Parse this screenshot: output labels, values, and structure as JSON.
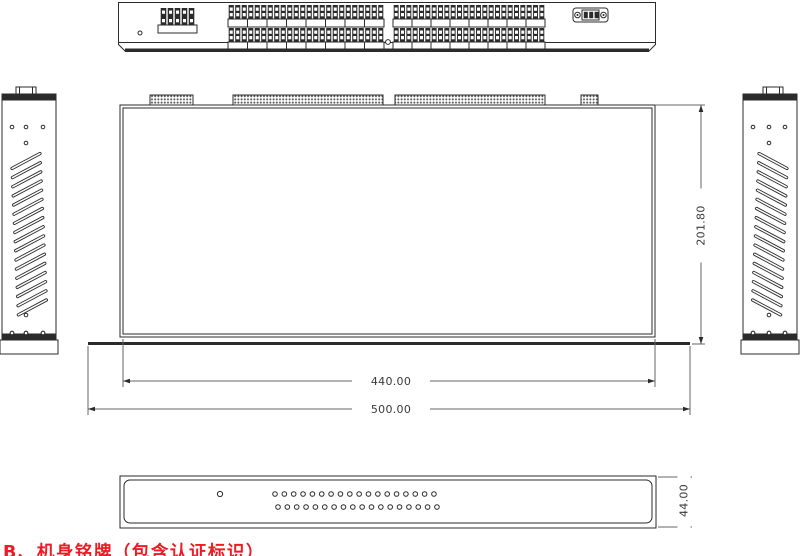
{
  "note": {
    "text": "B、机身铭牌（包含认证标识）"
  },
  "dimensions": {
    "inner_width_mm": "440.00",
    "outer_width_mm": "500.00",
    "depth_mm": "201.80",
    "height_mm": "44.00"
  },
  "views": {
    "rear_panel": {
      "small_terminal_pins": 5,
      "terminal_groups": [
        {
          "rows": 2,
          "segments": 8,
          "pins_per_segment": 3
        },
        {
          "rows": 2,
          "segments": 8,
          "pins_per_segment": 3
        }
      ],
      "connector": {
        "type": "db9-serial",
        "center_pins": 3
      }
    },
    "top_view": {
      "hatched_blocks": 4
    },
    "side_panels": {
      "vent_slats": 17,
      "corner_hole_count": 3,
      "center_hole_count": 1
    },
    "front_panel": {
      "hole_rows": 2,
      "holes_per_row": 18,
      "indicator_holes": 1
    }
  },
  "colors": {
    "line": "#2b2b2b",
    "ext_line": "#666666",
    "text": "#3a3a3a",
    "note_red": "#ed1c24",
    "background": "#ffffff"
  }
}
